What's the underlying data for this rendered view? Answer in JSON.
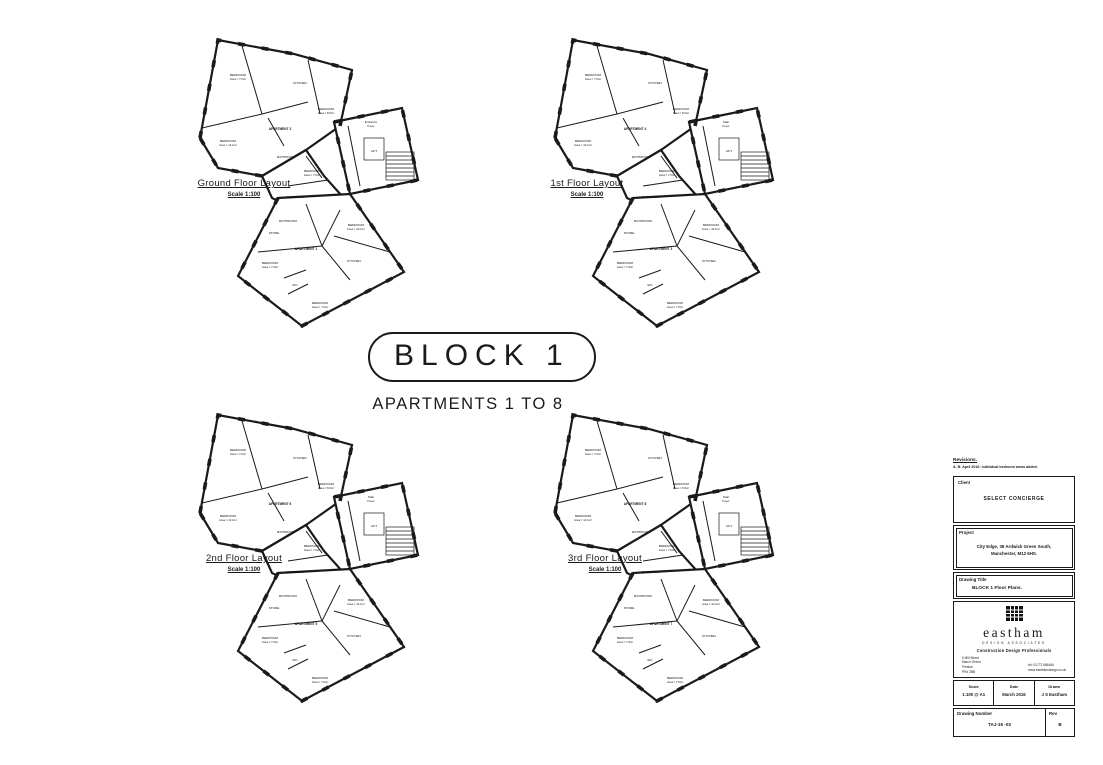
{
  "banner": {
    "title": "BLOCK 1",
    "subtitle": "APARTMENTS 1 TO 8"
  },
  "plans": [
    {
      "id": "ground",
      "label": "Ground Floor Layout",
      "scale": "Scale 1:100",
      "rooms": {
        "apartment_upper": [
          "APARTMENT 2"
        ],
        "apartment_lower": [
          "APARTMENT 1"
        ],
        "foyer": [
          "Entrance",
          "Foyer"
        ]
      }
    },
    {
      "id": "first",
      "label": "1st Floor Layout",
      "scale": "Scale 1:100",
      "rooms": {
        "apartment_upper": [
          "APARTMENT 4"
        ],
        "apartment_lower": [
          "APARTMENT 3"
        ],
        "foyer": [
          "Stair",
          "Foyer"
        ]
      }
    },
    {
      "id": "second",
      "label": "2nd Floor Layout",
      "scale": "Scale 1:100",
      "rooms": {
        "apartment_upper": [
          "APARTMENT 6"
        ],
        "apartment_lower": [
          "APARTMENT 5"
        ],
        "foyer": [
          "Stair",
          "Foyer"
        ]
      }
    },
    {
      "id": "third",
      "label": "3rd Floor Layout",
      "scale": "Scale 1:100",
      "rooms": {
        "apartment_upper": [
          "APARTMENT 8"
        ],
        "apartment_lower": [
          "APARTMENT 7"
        ],
        "foyer": [
          "Stair",
          "Foyer"
        ]
      }
    }
  ],
  "shared_rooms": {
    "bedroom_top_left": [
      "BEDROOM",
      "Area = 7.6m²"
    ],
    "kitchen_upper": [
      "KITCHEN"
    ],
    "bedroom_right": [
      "BEDROOM",
      "Area = 8.6m²"
    ],
    "bedroom_lower_left": [
      "BEDROOM",
      "Area = 12.1m²"
    ],
    "bathroom_upper": [
      "BATHROOM"
    ],
    "bedroom_mid": [
      "BEDROOM",
      "Area = 7.6m²"
    ],
    "bathroom_mid": [
      "BATHROOM"
    ],
    "lift": [
      "LIFT"
    ],
    "bathroom_lower": [
      "BATHROOM"
    ],
    "store": [
      "STORE"
    ],
    "bedroom_lower": [
      "BEDROOM",
      "Area = 7.9m²"
    ],
    "kitchen_lower": [
      "KITCHEN"
    ],
    "bedroom_lower_right": [
      "BEDROOM",
      "Area = 10.1m²"
    ],
    "wc": [
      "WC"
    ],
    "bedroom_bottom": [
      "BEDROOM",
      "Area = 7.6m²"
    ]
  },
  "title_block": {
    "revisions_heading": "Revisions.",
    "revisions_note": "A, B: April 2016: individual bedroom areas added.",
    "client_label": "Client",
    "client": "SELECT CONCIERGE",
    "project_label": "Project",
    "project_line1": "City Edge, 38 Ardwick Green South,",
    "project_line2": "Manchester, M12 6HS.",
    "drawing_title_label": "Drawing Title",
    "drawing_title": "BLOCK 1 Floor Plans.",
    "company": {
      "name": "eastham",
      "tagline": "DESIGN ASSOCIATES",
      "strapline": "Construction Design Professionals",
      "address": [
        "6 Mill Street",
        "Manor Green",
        "Preston",
        "PR4 2BB"
      ],
      "contact": [
        "tel: 01772 686466",
        "www.easthamdesign.co.uk"
      ]
    },
    "scale_label": "Scale",
    "scale": "1:100 @ A1",
    "date_label": "Date",
    "date": "March 2016",
    "drawn_label": "Drawn",
    "drawn": "J S Eastham",
    "drawing_number_label": "Drawing Number",
    "drawing_number": "TAJ-16 -03",
    "rev_label": "Rev",
    "rev": "B"
  },
  "colors": {
    "ink": "#1a1a1a",
    "paper": "#ffffff"
  }
}
